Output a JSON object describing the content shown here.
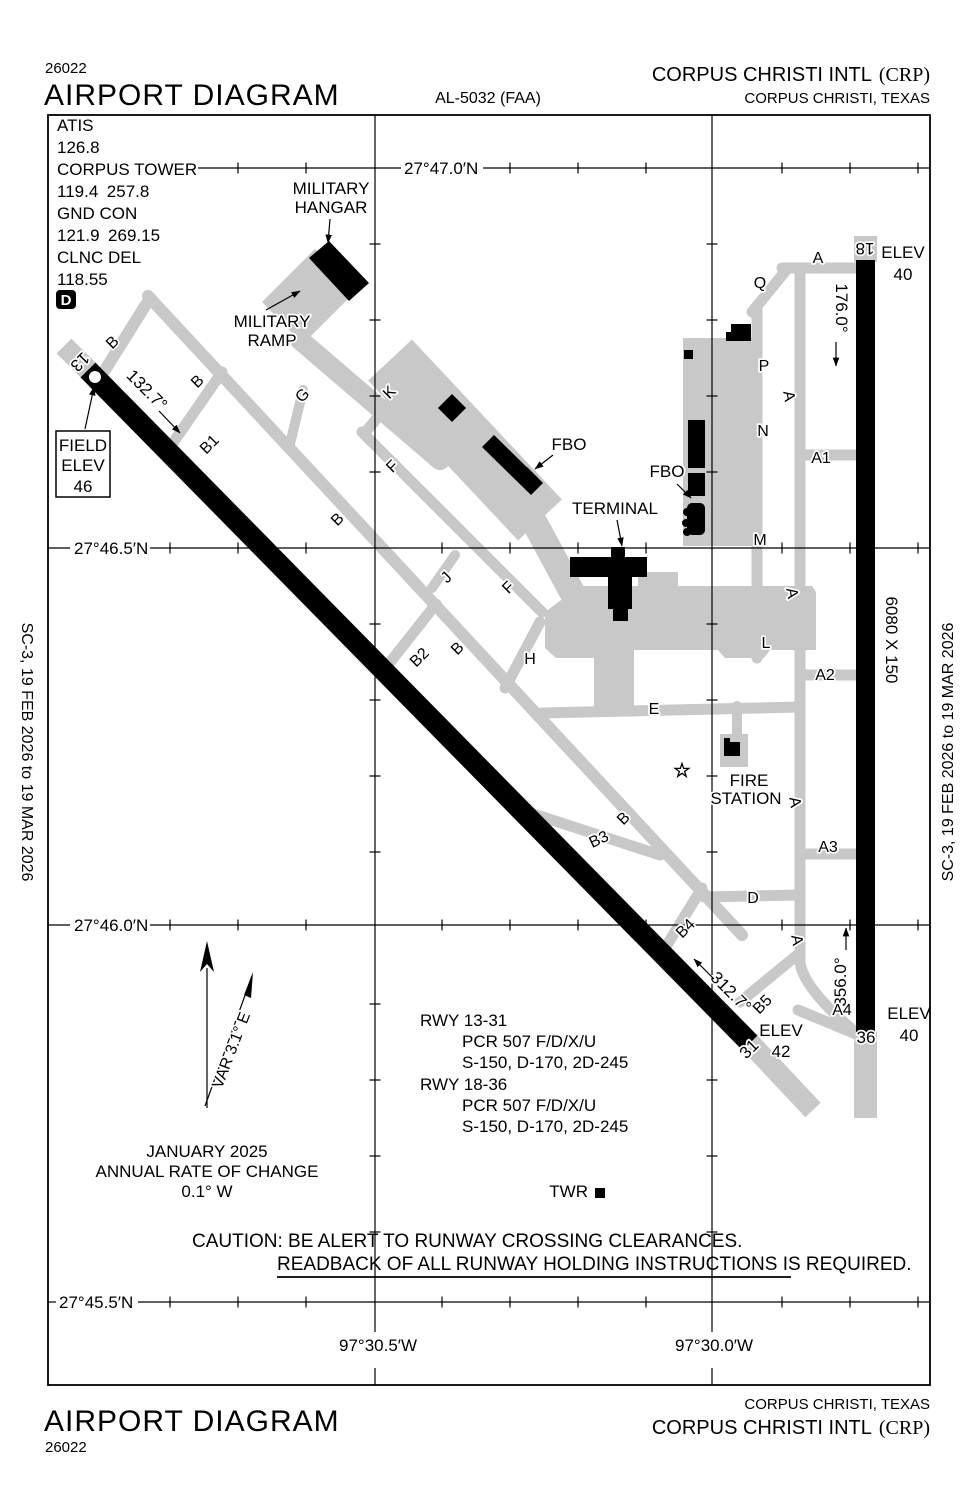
{
  "header": {
    "sheet_number": "26022",
    "title": "AIRPORT DIAGRAM",
    "chart_ref": "AL-5032 (FAA)",
    "airport": "CORPUS CHRISTI INTL",
    "code": "(CRP)",
    "city": "CORPUS CHRISTI, TEXAS"
  },
  "footer": {
    "sheet_number": "26022",
    "title": "AIRPORT DIAGRAM",
    "airport": "CORPUS CHRISTI INTL",
    "code": "(CRP)",
    "city": "CORPUS CHRISTI, TEXAS"
  },
  "edge": {
    "left": "SC-3,  19 FEB 2026  to  19 MAR 2026",
    "right": "SC-3,  19 FEB 2026  to  19 MAR 2026"
  },
  "freqs": {
    "atis_label": "ATIS",
    "atis": "126.8",
    "twr_label": "CORPUS TOWER",
    "twr": "119.4 257.8",
    "gnd_label": "GND CON",
    "gnd": "121.9 269.15",
    "clnc_label": "CLNC DEL",
    "clnc": "118.55",
    "d_symbol": "D"
  },
  "field_elev": {
    "l1": "FIELD",
    "l2": "ELEV",
    "l3": "46"
  },
  "grat": {
    "lat_470": "27°47.0′N",
    "lat_465": "27°46.5′N",
    "lat_460": "27°46.0′N",
    "lat_455": "27°45.5′N",
    "lon_305": "97°30.5′W",
    "lon_300": "97°30.0′W"
  },
  "rwy_13_31": {
    "dim": "7510 X 150",
    "end_13": "13",
    "end_31": "31",
    "hdg_13": "132.7°",
    "hdg_31": "312.7°",
    "elev_31_l1": "ELEV",
    "elev_31_l2": "42"
  },
  "rwy_18_36": {
    "dim": "6080 X 150",
    "end_18": "18",
    "end_36": "36",
    "hdg_18": "176.0°",
    "hdg_36": "356.0°",
    "elev_18_l1": "ELEV",
    "elev_18_l2": "40",
    "elev_36_l1": "ELEV",
    "elev_36_l2": "40"
  },
  "buildings": {
    "military_hangar_l1": "MILITARY",
    "military_hangar_l2": "HANGAR",
    "military_ramp_l1": "MILITARY",
    "military_ramp_l2": "RAMP",
    "fbo_west": "FBO",
    "fbo_east": "FBO",
    "terminal": "TERMINAL",
    "fire_l1": "FIRE",
    "fire_l2": "STATION",
    "twr": "TWR"
  },
  "compass": {
    "var": "VAR 3.1° E",
    "date": "JANUARY 2025",
    "rate_l1": "ANNUAL RATE OF CHANGE",
    "rate_l2": "0.1° W"
  },
  "rwy_data": {
    "r1": "RWY 13-31",
    "r1_pcr": "PCR 507 F/D/X/U",
    "r1_s": "S-150, D-170, 2D-245",
    "r2": "RWY 18-36",
    "r2_pcr": "PCR 507 F/D/X/U",
    "r2_s": "S-150, D-170, 2D-245"
  },
  "caution": {
    "l1": "CAUTION: BE ALERT TO RUNWAY CROSSING CLEARANCES.",
    "l2": "READBACK OF ALL RUNWAY HOLDING INSTRUCTIONS IS REQUIRED."
  },
  "taxiway_labels": [
    {
      "t": "B",
      "x": 116,
      "y": 346,
      "r": -45
    },
    {
      "t": "B",
      "x": 201,
      "y": 385,
      "r": -45
    },
    {
      "t": "B1",
      "x": 213,
      "y": 448,
      "r": -45
    },
    {
      "t": "G",
      "x": 306,
      "y": 399,
      "r": -45
    },
    {
      "t": "K",
      "x": 393,
      "y": 396,
      "r": -45
    },
    {
      "t": "F",
      "x": 396,
      "y": 470,
      "r": -45
    },
    {
      "t": "B",
      "x": 341,
      "y": 523,
      "r": -45
    },
    {
      "t": "J",
      "x": 450,
      "y": 581,
      "r": -45
    },
    {
      "t": "F",
      "x": 512,
      "y": 591,
      "r": -45
    },
    {
      "t": "B2",
      "x": 423,
      "y": 661,
      "r": -45
    },
    {
      "t": "B",
      "x": 461,
      "y": 652,
      "r": -45
    },
    {
      "t": "H",
      "x": 530,
      "y": 664,
      "r": 0
    },
    {
      "t": "E",
      "x": 654,
      "y": 714,
      "r": 0
    },
    {
      "t": "B",
      "x": 627,
      "y": 822,
      "r": -45
    },
    {
      "t": "B3",
      "x": 601,
      "y": 844,
      "r": -25
    },
    {
      "t": "B4",
      "x": 689,
      "y": 932,
      "r": -45
    },
    {
      "t": "D",
      "x": 753,
      "y": 903,
      "r": 0
    },
    {
      "t": "B5",
      "x": 766,
      "y": 1008,
      "r": -45
    },
    {
      "t": "Q",
      "x": 760,
      "y": 288,
      "r": 0
    },
    {
      "t": "A",
      "x": 818,
      "y": 263,
      "r": 0
    },
    {
      "t": "P",
      "x": 764,
      "y": 371,
      "r": 0
    },
    {
      "t": "A",
      "x": 784,
      "y": 397,
      "r": 80
    },
    {
      "t": "N",
      "x": 763,
      "y": 436,
      "r": 0
    },
    {
      "t": "A1",
      "x": 821,
      "y": 463,
      "r": 0
    },
    {
      "t": "M",
      "x": 760,
      "y": 545,
      "r": 0
    },
    {
      "t": "A",
      "x": 787,
      "y": 594,
      "r": 80
    },
    {
      "t": "L",
      "x": 766,
      "y": 648,
      "r": 0
    },
    {
      "t": "A2",
      "x": 825,
      "y": 680,
      "r": 0
    },
    {
      "t": "A",
      "x": 790,
      "y": 803,
      "r": 80
    },
    {
      "t": "A3",
      "x": 828,
      "y": 852,
      "r": 0
    },
    {
      "t": "A",
      "x": 792,
      "y": 941,
      "r": 80
    },
    {
      "t": "A4",
      "x": 842,
      "y": 1015,
      "r": 0
    }
  ]
}
